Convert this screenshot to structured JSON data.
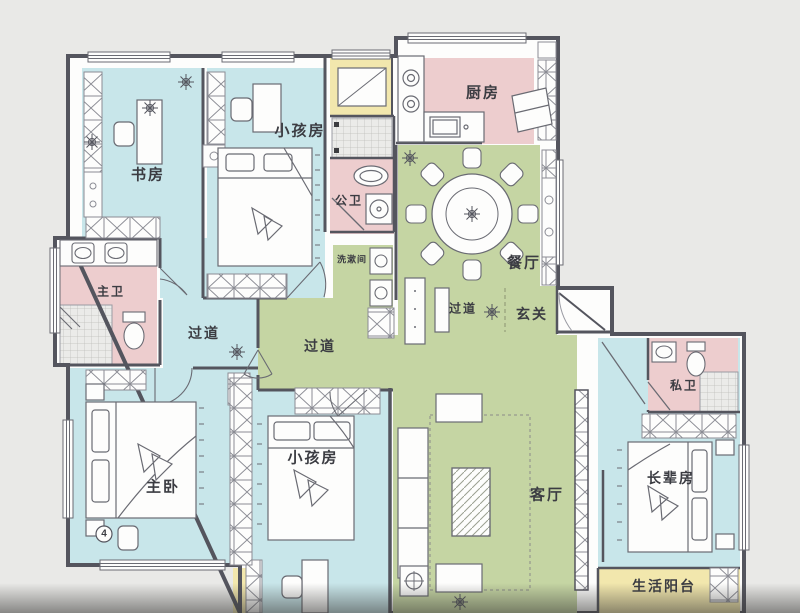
{
  "plan": {
    "labels": {
      "study": "书房",
      "kids_top": "小孩房",
      "public_bath": "公卫",
      "laundry": "洗漱间",
      "kitchen": "厨房",
      "dining": "餐厅",
      "corridor_a": "过道",
      "foyer": "玄关",
      "corridor_b": "过道",
      "corridor_c": "过道",
      "master_bath": "主卫",
      "master_bedroom": "主卧",
      "kids_bottom": "小孩房",
      "living": "客厅",
      "private_bath": "私卫",
      "elder": "长辈房",
      "balcony": "生活阳台",
      "marker": "4"
    },
    "colors": {
      "background": "#e9e9e7",
      "bedroom_fill": "#c8e6ea",
      "public_area_fill": "#c5d5a3",
      "bathroom_fill": "#edcdce",
      "balcony_fill": "#f2e7ad",
      "tile_fill": "#ebebe9",
      "wall": "#54555e"
    }
  }
}
